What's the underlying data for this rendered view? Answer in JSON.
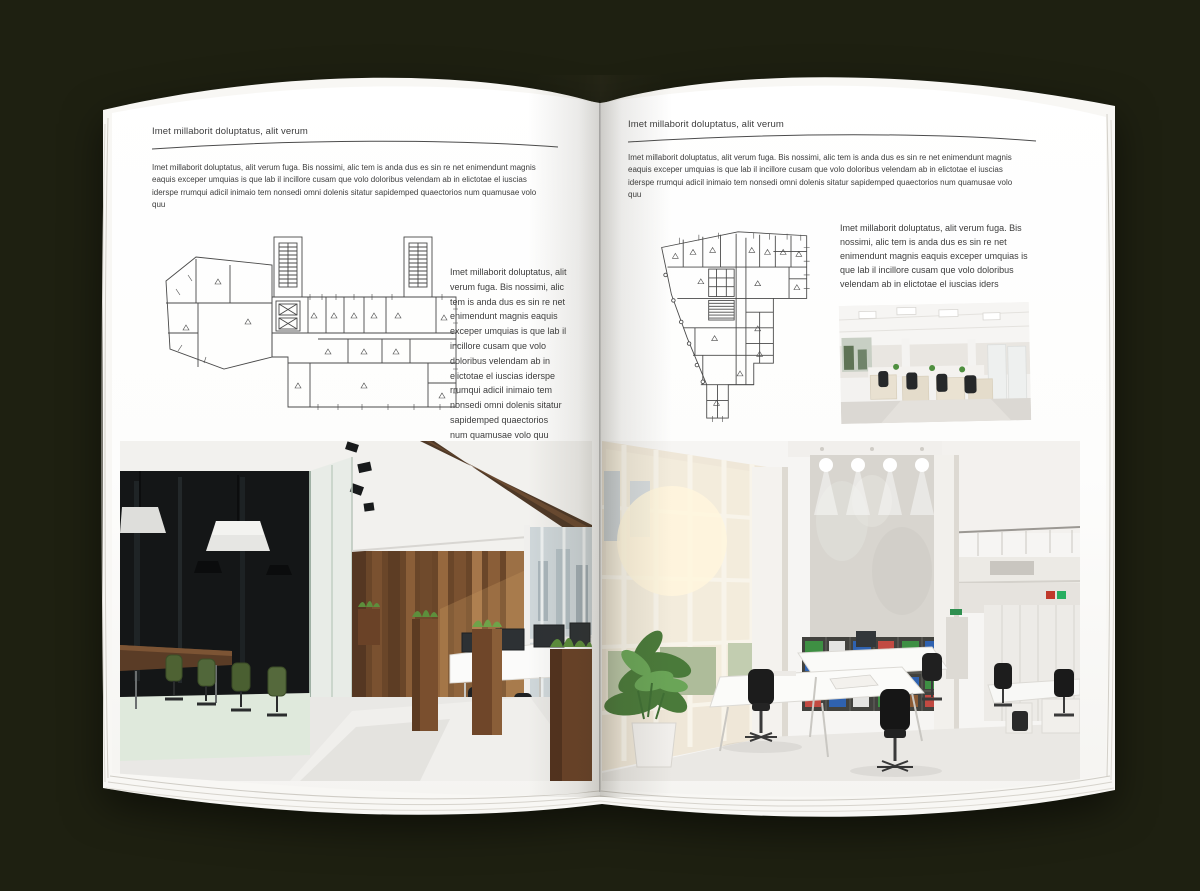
{
  "background_color": "#1e2011",
  "book": {
    "pages": [
      {
        "side": "left",
        "header": "Imet millaborit doluptatus, alit verum",
        "intro": "Imet millaborit doluptatus, alit verum fuga. Bis nossimi, alic tem is anda dus es sin re net enimendunt magnis eaquis exceper umquias is que lab il incillore cusam que volo doloribus velendam ab in elictotae el iuscias iderspe rrumqui adicil inimaio tem nonsedi omni dolenis sitatur sapidemped quaectorios num quamusae volo quu",
        "figure_caption": "Imet millaborit doluptatus, alit verum fuga. Bis nossimi, alic tem is anda dus es sin re net enimendunt magnis eaquis exceper umquias is que lab il incillore cusam que volo doloribus velendam ab in elictotae el iuscias iderspe rrumqui adicil inimaio tem nonsedi omni dolenis sitatur sapidemped quaectorios num quamusae volo quu",
        "figures": {
          "floorplan": "wide-building-floor-plan-drawing",
          "photo": "loft-office-interior-wood-wall-green-chairs"
        }
      },
      {
        "side": "right",
        "header": "Imet millaborit doluptatus, alit verum",
        "intro": "Imet millaborit doluptatus, alit verum fuga. Bis nossimi, alic tem is anda dus es sin re net enimendunt magnis eaquis exceper umquias is que lab il incillore cusam que volo doloribus velendam ab in elictotae el iuscias iderspe rrumqui adicil inimaio tem nonsedi omni dolenis sitatur sapidemped quaectorios num quamusae volo quu",
        "figure_caption": "Imet millaborit doluptatus, alit verum fuga. Bis nossimi, alic tem is anda dus es sin re net enimendunt magnis eaquis exceper umquias is que lab il incillore cusam que volo doloribus velendam ab in elictotae el iuscias iders",
        "figures": {
          "floorplan": "irregular-building-floor-plan-drawing",
          "photo_small": "open-office-rows-of-desks",
          "photo": "bright-atrium-office-bookshelves"
        }
      }
    ]
  },
  "palette": {
    "page": "#fdfdfc",
    "text": "#3d3d3d",
    "plan_line": "#4a4a4a",
    "wood_dark": "#5d3d24",
    "wood_light": "#8a5e38",
    "chair_green": "#4e6233",
    "plant_green": "#579347",
    "binder_green": "#3e8f43",
    "binder_blue": "#2f62b0",
    "binder_red": "#c24a42",
    "concrete": "#d8d5cf",
    "floor": "#e9e8e5"
  }
}
